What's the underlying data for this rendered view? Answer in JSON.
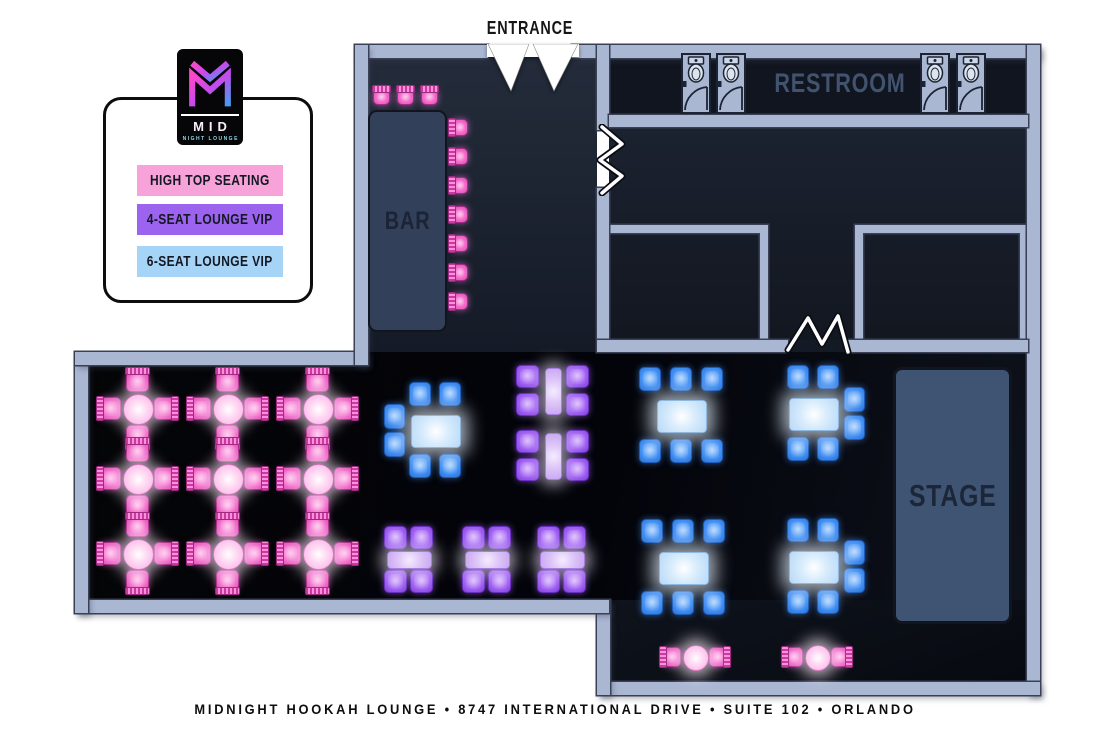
{
  "labels": {
    "entrance": "ENTRANCE",
    "bar": "BAR",
    "restroom": "RESTROOM",
    "stage": "STAGE"
  },
  "logo": {
    "mid": "MID",
    "sub": "NIGHT LOUNGE"
  },
  "legend": {
    "items": [
      {
        "label": "HIGH TOP SEATING",
        "color": "#f7a3d9"
      },
      {
        "label": "4-SEAT LOUNGE VIP",
        "color": "#9c63ee"
      },
      {
        "label": "6-SEAT LOUNGE VIP",
        "color": "#a6d4f6"
      }
    ]
  },
  "footer": {
    "text": "MIDNIGHT HOOKAH LOUNGE • 8747 INTERNATIONAL DRIVE • SUITE 102 • ORLANDO"
  },
  "colors": {
    "wall": "#aab7d3",
    "pink_seat": "#f15fc9",
    "purple_seat": "#9a5cf0",
    "blue_seat": "#3d8ef0"
  },
  "floor_elements": [
    {
      "type": "hightop4",
      "x": 137,
      "y": 408
    },
    {
      "type": "hightop4",
      "x": 227,
      "y": 408
    },
    {
      "type": "hightop4",
      "x": 317,
      "y": 408
    },
    {
      "type": "hightop4",
      "x": 137,
      "y": 478
    },
    {
      "type": "hightop4",
      "x": 227,
      "y": 478
    },
    {
      "type": "hightop4",
      "x": 317,
      "y": 478
    },
    {
      "type": "hightop4",
      "x": 137,
      "y": 553
    },
    {
      "type": "hightop4",
      "x": 227,
      "y": 553
    },
    {
      "type": "hightop4",
      "x": 317,
      "y": 553
    },
    {
      "type": "hightop2",
      "x": 695,
      "y": 657
    },
    {
      "type": "hightop2",
      "x": 817,
      "y": 657
    },
    {
      "type": "vip6",
      "variant": "2T2B2L",
      "x": 435,
      "y": 430
    },
    {
      "type": "vip6",
      "variant": "3T3B",
      "x": 681,
      "y": 415
    },
    {
      "type": "vip6",
      "variant": "2T2B2R",
      "x": 813,
      "y": 413
    },
    {
      "type": "vip6",
      "variant": "3T3B",
      "x": 683,
      "y": 567
    },
    {
      "type": "vip6",
      "variant": "2T2B2R",
      "x": 813,
      "y": 566
    },
    {
      "type": "vip4v",
      "x": 552,
      "y": 390
    },
    {
      "type": "vip4v",
      "x": 552,
      "y": 455
    },
    {
      "type": "vip4h",
      "x": 408,
      "y": 559
    },
    {
      "type": "vip4h",
      "x": 486,
      "y": 559
    },
    {
      "type": "vip4h",
      "x": 561,
      "y": 559
    },
    {
      "type": "stool_n",
      "x": 381,
      "y": 97
    },
    {
      "type": "stool_n",
      "x": 405,
      "y": 97
    },
    {
      "type": "stool_n",
      "x": 429,
      "y": 97
    },
    {
      "type": "stool_w",
      "x": 460,
      "y": 127
    },
    {
      "type": "stool_w",
      "x": 460,
      "y": 156
    },
    {
      "type": "stool_w",
      "x": 460,
      "y": 185
    },
    {
      "type": "stool_w",
      "x": 460,
      "y": 214
    },
    {
      "type": "stool_w",
      "x": 460,
      "y": 243
    },
    {
      "type": "stool_w",
      "x": 460,
      "y": 272
    },
    {
      "type": "stool_w",
      "x": 460,
      "y": 301
    }
  ]
}
